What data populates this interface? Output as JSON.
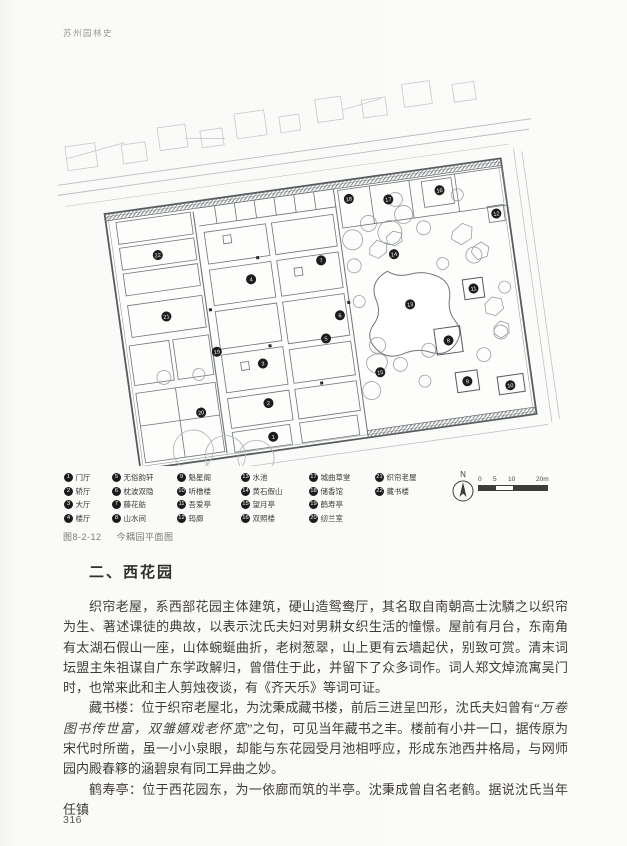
{
  "page": {
    "running_header": "苏州园林史",
    "page_number": "316"
  },
  "figure": {
    "caption_label": "图8-2-12",
    "caption_title": "今耦园平面图",
    "north_label": "N",
    "scale_labels": [
      "0",
      "5",
      "10",
      "20m"
    ],
    "legend": {
      "items": [
        {
          "n": "1",
          "label": "门厅"
        },
        {
          "n": "2",
          "label": "轿厅"
        },
        {
          "n": "3",
          "label": "大厅"
        },
        {
          "n": "4",
          "label": "楼厅"
        },
        {
          "n": "5",
          "label": "无俗韵轩"
        },
        {
          "n": "6",
          "label": "枕波双隐"
        },
        {
          "n": "7",
          "label": "藤花舫"
        },
        {
          "n": "8",
          "label": "山水间"
        },
        {
          "n": "9",
          "label": "魁星阁"
        },
        {
          "n": "10",
          "label": "听橹楼"
        },
        {
          "n": "11",
          "label": "吾爱亭"
        },
        {
          "n": "12",
          "label": "筠廊"
        },
        {
          "n": "13",
          "label": "水池"
        },
        {
          "n": "14",
          "label": "黄石假山"
        },
        {
          "n": "15",
          "label": "望月亭"
        },
        {
          "n": "16",
          "label": "双照楼"
        },
        {
          "n": "17",
          "label": "城曲草堂"
        },
        {
          "n": "18",
          "label": "储香馆"
        },
        {
          "n": "19",
          "label": "鹤寿亭"
        },
        {
          "n": "20",
          "label": "纫兰室"
        },
        {
          "n": "21",
          "label": "织帘老屋"
        },
        {
          "n": "22",
          "label": "藏书楼"
        }
      ]
    },
    "plan_markers": [
      {
        "n": "1",
        "x": 196,
        "y": 374
      },
      {
        "n": "2",
        "x": 196,
        "y": 340
      },
      {
        "n": "3",
        "x": 196,
        "y": 300
      },
      {
        "n": "4",
        "x": 196,
        "y": 215
      },
      {
        "n": "5",
        "x": 262,
        "y": 284
      },
      {
        "n": "6",
        "x": 279,
        "y": 263
      },
      {
        "n": "7",
        "x": 268,
        "y": 206
      },
      {
        "n": "8",
        "x": 383,
        "y": 303
      },
      {
        "n": "9",
        "x": 396,
        "y": 346
      },
      {
        "n": "10",
        "x": 438,
        "y": 356
      },
      {
        "n": "11",
        "x": 415,
        "y": 255
      },
      {
        "n": "12",
        "x": 448,
        "y": 184
      },
      {
        "n": "13",
        "x": 350,
        "y": 262
      },
      {
        "n": "14",
        "x": 341,
        "y": 210
      },
      {
        "n": "15",
        "x": 311,
        "y": 325
      },
      {
        "n": "16",
        "x": 395,
        "y": 153
      },
      {
        "n": "17",
        "x": 343,
        "y": 155
      },
      {
        "n": "18",
        "x": 304,
        "y": 149
      },
      {
        "n": "19",
        "x": 152,
        "y": 282
      },
      {
        "n": "20",
        "x": 128,
        "y": 340
      },
      {
        "n": "21",
        "x": 107,
        "y": 240
      },
      {
        "n": "22",
        "x": 107,
        "y": 178
      }
    ]
  },
  "section": {
    "heading": "二、西花园",
    "p1": "织帘老屋，系西部花园主体建筑，硬山造鸳鸯厅，其名取自南朝高士沈驎之以织帘为生、著述课徒的典故，以表示沈氏夫妇对男耕女织生活的憧憬。屋前有月台，东南角有太湖石假山一座，山体蜿蜒曲折，老树葱翠，山上更有云墙起伏，别致可赏。清末词坛盟主朱祖谋自广东学政解归，曾借住于此，并留下了众多词作。词人郑文焯流寓吴门时，也常来此和主人剪烛夜谈，有《齐天乐》等词可证。",
    "p2_pre": "藏书楼：位于织帘老屋北，为沈秉成藏书楼，前后三进呈凹形，沈氏夫妇曾有“",
    "p2_quote": "万卷图书传世富，双雏嬉戏老怀宽",
    "p2_post": "”之句，可见当年藏书之丰。楼前有小井一口，据传原为宋代时所凿，虽一小小泉眼，却能与东花园受月池相呼应，形成东池西井格局，与网师园内殿春簃的涵碧泉有同工异曲之妙。",
    "p3": "鹤寿亭：位于西花园东，为一依廊而筑的半亭。沈秉成曾自名老鹤。据说沈氏当年任镇"
  }
}
